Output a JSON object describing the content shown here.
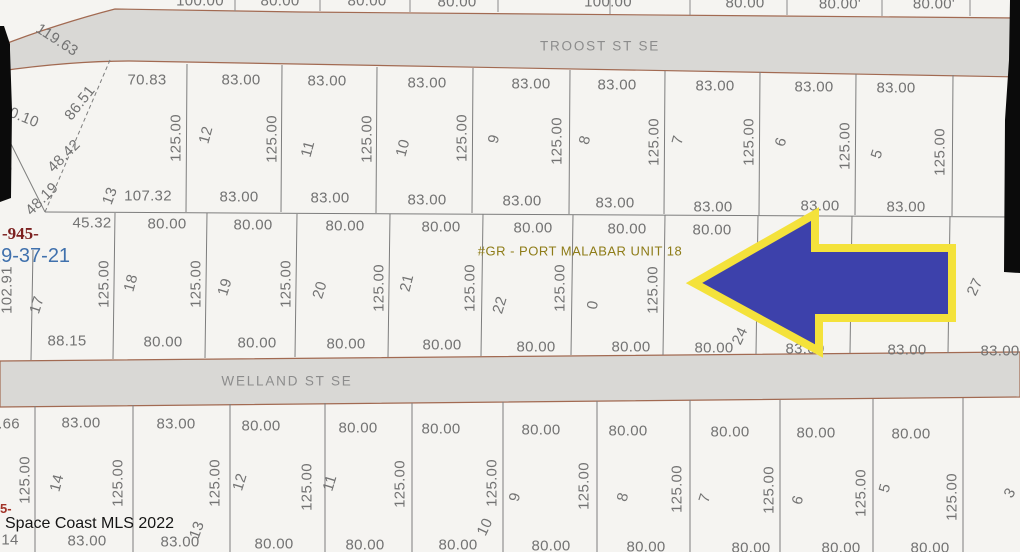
{
  "map": {
    "streets": {
      "troost": "TROOST ST SE",
      "welland": "WELLAND ST SE"
    },
    "plat_label": "#GR - PORT MALABAR UNIT 18",
    "red_parcel_code": "-945-",
    "red_fragment": "5-",
    "section_township_range": "29-37-21",
    "watermark": "Space Coast MLS 2022",
    "arrow": {
      "direction": "left",
      "fill": "#3d41ab",
      "outline": "#f4e23b"
    },
    "colors": {
      "street_fill": "#d9d8d5",
      "street_border": "#a26a52",
      "parcel_fill": "#f5f4f1",
      "lot_line": "#7d7d7d",
      "dim_text": "#737373"
    },
    "labels": [
      {
        "t": "100.00",
        "x": 200,
        "y": 1
      },
      {
        "t": "80.00",
        "x": 280,
        "y": 1
      },
      {
        "t": "80.00",
        "x": 367,
        "y": 1
      },
      {
        "t": "80.00",
        "x": 457,
        "y": 2
      },
      {
        "t": "100.00",
        "x": 608,
        "y": 2
      },
      {
        "t": "80.00",
        "x": 745,
        "y": 3
      },
      {
        "t": "80.00'",
        "x": 840,
        "y": 4
      },
      {
        "t": "80.00'",
        "x": 934,
        "y": 4
      },
      {
        "t": "70.83",
        "x": 147,
        "y": 80
      },
      {
        "t": "83.00",
        "x": 241,
        "y": 80
      },
      {
        "t": "83.00",
        "x": 327,
        "y": 81
      },
      {
        "t": "83.00",
        "x": 427,
        "y": 83
      },
      {
        "t": "83.00",
        "x": 531,
        "y": 84
      },
      {
        "t": "83.00",
        "x": 617,
        "y": 85
      },
      {
        "t": "83.00",
        "x": 715,
        "y": 86
      },
      {
        "t": "83.00",
        "x": 814,
        "y": 87
      },
      {
        "t": "83.00",
        "x": 896,
        "y": 88
      },
      {
        "t": "125.00",
        "x": 176,
        "y": 138,
        "r": -90,
        "n": "lot-depth-label"
      },
      {
        "t": "125.00",
        "x": 272,
        "y": 139,
        "r": -90,
        "n": "lot-depth-label"
      },
      {
        "t": "125.00",
        "x": 367,
        "y": 139,
        "r": -90,
        "n": "lot-depth-label"
      },
      {
        "t": "125.00",
        "x": 462,
        "y": 138,
        "r": -90,
        "n": "lot-depth-label"
      },
      {
        "t": "125.00",
        "x": 557,
        "y": 141,
        "r": -90,
        "n": "lot-depth-label"
      },
      {
        "t": "125.00",
        "x": 654,
        "y": 142,
        "r": -90,
        "n": "lot-depth-label"
      },
      {
        "t": "125.00",
        "x": 749,
        "y": 142,
        "r": -90,
        "n": "lot-depth-label"
      },
      {
        "t": "125.00",
        "x": 845,
        "y": 146,
        "r": -90,
        "n": "lot-depth-label"
      },
      {
        "t": "125.00",
        "x": 940,
        "y": 152,
        "r": -90,
        "n": "lot-depth-label"
      },
      {
        "t": "12",
        "x": 206,
        "y": 135,
        "r": -75,
        "n": "lot-number"
      },
      {
        "t": "11",
        "x": 308,
        "y": 149,
        "r": -75,
        "n": "lot-number"
      },
      {
        "t": "10",
        "x": 403,
        "y": 148,
        "r": -75,
        "n": "lot-number"
      },
      {
        "t": "9",
        "x": 494,
        "y": 139,
        "r": -75,
        "n": "lot-number"
      },
      {
        "t": "8",
        "x": 585,
        "y": 140,
        "r": -75,
        "n": "lot-number"
      },
      {
        "t": "7",
        "x": 678,
        "y": 140,
        "r": -75,
        "n": "lot-number"
      },
      {
        "t": "6",
        "x": 781,
        "y": 142,
        "r": -72,
        "n": "lot-number"
      },
      {
        "t": "5",
        "x": 877,
        "y": 154,
        "r": -72,
        "n": "lot-number"
      },
      {
        "t": "13",
        "x": 110,
        "y": 196,
        "r": -70,
        "n": "lot-number"
      },
      {
        "t": "107.32",
        "x": 148,
        "y": 196
      },
      {
        "t": "83.00",
        "x": 239,
        "y": 197
      },
      {
        "t": "83.00",
        "x": 330,
        "y": 198
      },
      {
        "t": "83.00",
        "x": 427,
        "y": 200
      },
      {
        "t": "83.00",
        "x": 522,
        "y": 201
      },
      {
        "t": "83.00",
        "x": 615,
        "y": 203
      },
      {
        "t": "83.00",
        "x": 713,
        "y": 207
      },
      {
        "t": "83.00",
        "x": 820,
        "y": 206
      },
      {
        "t": "83.00",
        "x": 906,
        "y": 207
      },
      {
        "t": "119.63",
        "x": 57,
        "y": 40,
        "r": 33,
        "n": "boundary-length-label"
      },
      {
        "t": "30.10",
        "x": 20,
        "y": 116,
        "r": 22,
        "n": "boundary-length-label"
      },
      {
        "t": "86.51",
        "x": 80,
        "y": 103,
        "r": -52,
        "n": "boundary-length-label"
      },
      {
        "t": "48.42",
        "x": 64,
        "y": 156,
        "r": -45,
        "n": "boundary-length-label"
      },
      {
        "t": "48.19",
        "x": 42,
        "y": 199,
        "r": -45,
        "n": "boundary-length-label"
      },
      {
        "t": "5",
        "x": 7,
        "y": 168,
        "r": -50,
        "n": "boundary-length-label"
      },
      {
        "t": "45.32",
        "x": 92,
        "y": 223
      },
      {
        "t": "80.00",
        "x": 167,
        "y": 224
      },
      {
        "t": "80.00",
        "x": 253,
        "y": 225
      },
      {
        "t": "80.00",
        "x": 345,
        "y": 226
      },
      {
        "t": "80.00",
        "x": 441,
        "y": 227
      },
      {
        "t": "80.00",
        "x": 533,
        "y": 228
      },
      {
        "t": "80.00",
        "x": 627,
        "y": 229
      },
      {
        "t": "80.00",
        "x": 712,
        "y": 230
      },
      {
        "t": "125.00",
        "x": 104,
        "y": 284,
        "r": -90,
        "n": "lot-depth-label"
      },
      {
        "t": "125.00",
        "x": 196,
        "y": 284,
        "r": -90,
        "n": "lot-depth-label"
      },
      {
        "t": "125.00",
        "x": 286,
        "y": 284,
        "r": -90,
        "n": "lot-depth-label"
      },
      {
        "t": "125.00",
        "x": 379,
        "y": 288,
        "r": -90,
        "n": "lot-depth-label"
      },
      {
        "t": "125.00",
        "x": 470,
        "y": 288,
        "r": -90,
        "n": "lot-depth-label"
      },
      {
        "t": "125.00",
        "x": 560,
        "y": 288,
        "r": -90,
        "n": "lot-depth-label"
      },
      {
        "t": "125.00",
        "x": 653,
        "y": 290,
        "r": -90,
        "n": "lot-depth-label"
      },
      {
        "t": "17",
        "x": 37,
        "y": 305,
        "r": -72,
        "n": "lot-number"
      },
      {
        "t": "18",
        "x": 131,
        "y": 283,
        "r": -75,
        "n": "lot-number"
      },
      {
        "t": "19",
        "x": 225,
        "y": 287,
        "r": -73,
        "n": "lot-number"
      },
      {
        "t": "20",
        "x": 320,
        "y": 290,
        "r": -73,
        "n": "lot-number"
      },
      {
        "t": "21",
        "x": 407,
        "y": 283,
        "r": -76,
        "n": "lot-number"
      },
      {
        "t": "22",
        "x": 500,
        "y": 305,
        "r": -73,
        "n": "lot-number"
      },
      {
        "t": "0",
        "x": 593,
        "y": 305,
        "r": -80,
        "n": "lot-number"
      },
      {
        "t": "24",
        "x": 740,
        "y": 336,
        "r": -65,
        "n": "lot-number"
      },
      {
        "t": "27",
        "x": 975,
        "y": 287,
        "r": -65,
        "n": "lot-number"
      },
      {
        "t": "102.91",
        "x": 7,
        "y": 290,
        "r": -90,
        "n": "boundary-length-label"
      },
      {
        "t": "88.15",
        "x": 67,
        "y": 341
      },
      {
        "t": "80.00",
        "x": 163,
        "y": 342
      },
      {
        "t": "80.00",
        "x": 257,
        "y": 343
      },
      {
        "t": "80.00",
        "x": 346,
        "y": 344
      },
      {
        "t": "80.00",
        "x": 442,
        "y": 345
      },
      {
        "t": "80.00",
        "x": 536,
        "y": 347
      },
      {
        "t": "80.00",
        "x": 631,
        "y": 347
      },
      {
        "t": "80.00",
        "x": 714,
        "y": 348
      },
      {
        "t": "83.00",
        "x": 805,
        "y": 349
      },
      {
        "t": "83.00",
        "x": 907,
        "y": 350
      },
      {
        "t": "83.00",
        "x": 1000,
        "y": 351
      },
      {
        "t": ".66",
        "x": 9,
        "y": 424
      },
      {
        "t": "83.00",
        "x": 81,
        "y": 423
      },
      {
        "t": "83.00",
        "x": 176,
        "y": 424
      },
      {
        "t": "80.00",
        "x": 261,
        "y": 426
      },
      {
        "t": "80.00",
        "x": 358,
        "y": 428
      },
      {
        "t": "80.00",
        "x": 441,
        "y": 429
      },
      {
        "t": "80.00",
        "x": 541,
        "y": 430
      },
      {
        "t": "80.00",
        "x": 628,
        "y": 431
      },
      {
        "t": "80.00",
        "x": 730,
        "y": 432
      },
      {
        "t": "80.00",
        "x": 816,
        "y": 433
      },
      {
        "t": "80.00",
        "x": 911,
        "y": 434
      },
      {
        "t": "125.00",
        "x": 25,
        "y": 480,
        "r": -90,
        "n": "lot-depth-label"
      },
      {
        "t": "125.00",
        "x": 118,
        "y": 483,
        "r": -90,
        "n": "lot-depth-label"
      },
      {
        "t": "125.00",
        "x": 215,
        "y": 483,
        "r": -90,
        "n": "lot-depth-label"
      },
      {
        "t": "125.00",
        "x": 307,
        "y": 487,
        "r": -90,
        "n": "lot-depth-label"
      },
      {
        "t": "125.00",
        "x": 400,
        "y": 484,
        "r": -90,
        "n": "lot-depth-label"
      },
      {
        "t": "125.00",
        "x": 492,
        "y": 483,
        "r": -90,
        "n": "lot-depth-label"
      },
      {
        "t": "125.00",
        "x": 584,
        "y": 486,
        "r": -90,
        "n": "lot-depth-label"
      },
      {
        "t": "125.00",
        "x": 677,
        "y": 489,
        "r": -90,
        "n": "lot-depth-label"
      },
      {
        "t": "125.00",
        "x": 769,
        "y": 490,
        "r": -90,
        "n": "lot-depth-label"
      },
      {
        "t": "125.00",
        "x": 861,
        "y": 493,
        "r": -90,
        "n": "lot-depth-label"
      },
      {
        "t": "125.00",
        "x": 952,
        "y": 497,
        "r": -90,
        "n": "lot-depth-label"
      },
      {
        "t": "14",
        "x": 57,
        "y": 483,
        "r": -75,
        "n": "lot-number"
      },
      {
        "t": "13",
        "x": 197,
        "y": 530,
        "r": -70,
        "n": "lot-number"
      },
      {
        "t": "12",
        "x": 240,
        "y": 482,
        "r": -73,
        "n": "lot-number"
      },
      {
        "t": "11",
        "x": 330,
        "y": 483,
        "r": -73,
        "n": "lot-number"
      },
      {
        "t": "10",
        "x": 485,
        "y": 527,
        "r": -65,
        "n": "lot-number"
      },
      {
        "t": "9",
        "x": 515,
        "y": 497,
        "r": -75,
        "n": "lot-number"
      },
      {
        "t": "8",
        "x": 623,
        "y": 497,
        "r": -75,
        "n": "lot-number"
      },
      {
        "t": "7",
        "x": 705,
        "y": 498,
        "r": -73,
        "n": "lot-number"
      },
      {
        "t": "6",
        "x": 798,
        "y": 500,
        "r": -73,
        "n": "lot-number"
      },
      {
        "t": "5",
        "x": 885,
        "y": 488,
        "r": -75,
        "n": "lot-number"
      },
      {
        "t": "3",
        "x": 1010,
        "y": 493,
        "r": -60,
        "n": "lot-number"
      },
      {
        "t": "14",
        "x": 10,
        "y": 540
      },
      {
        "t": "83.00",
        "x": 87,
        "y": 541
      },
      {
        "t": "83.00",
        "x": 180,
        "y": 542
      },
      {
        "t": "80.00",
        "x": 274,
        "y": 544
      },
      {
        "t": "80.00",
        "x": 365,
        "y": 545
      },
      {
        "t": "80.00",
        "x": 458,
        "y": 545
      },
      {
        "t": "80.00",
        "x": 551,
        "y": 546
      },
      {
        "t": "80.00",
        "x": 646,
        "y": 547
      },
      {
        "t": "80.00",
        "x": 751,
        "y": 548
      },
      {
        "t": "80.00",
        "x": 841,
        "y": 548
      },
      {
        "t": "80.00",
        "x": 930,
        "y": 548
      }
    ]
  }
}
